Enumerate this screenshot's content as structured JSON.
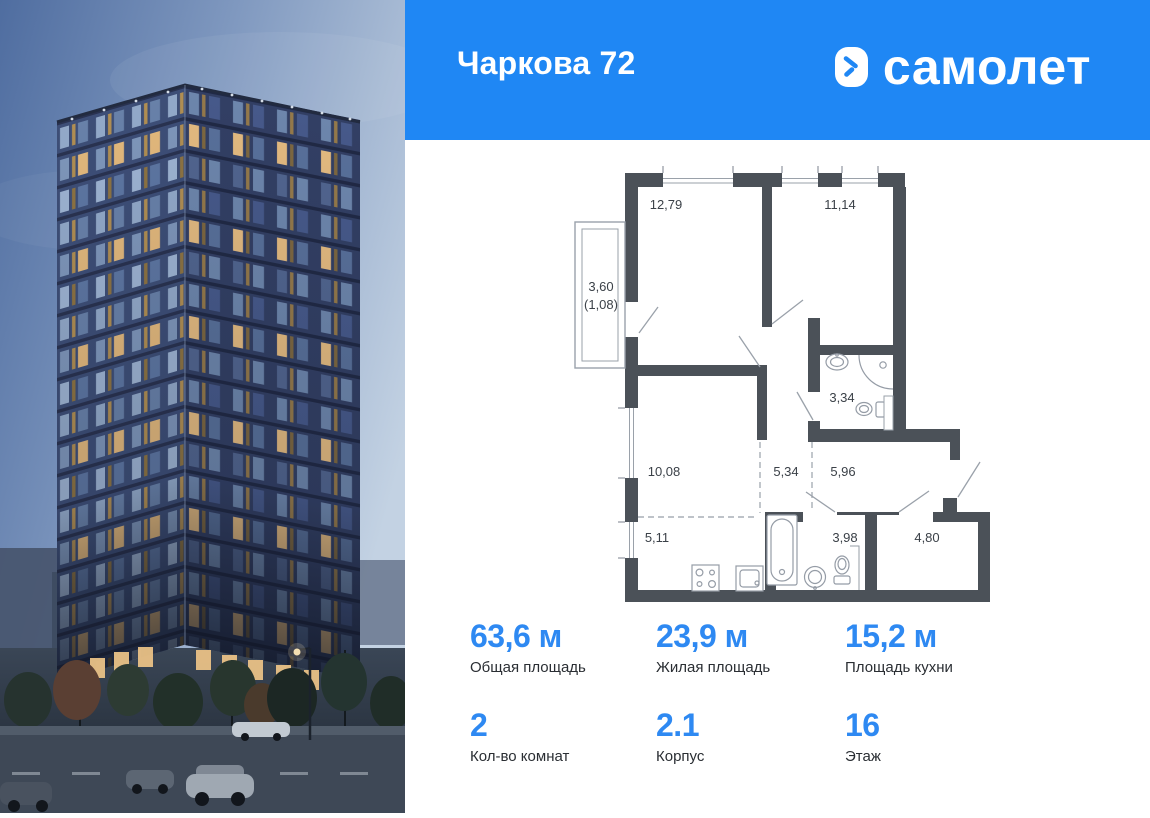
{
  "header": {
    "title": "Чаркова 72",
    "brand": "самолет",
    "bg_color": "#1f87f4"
  },
  "floor_plan": {
    "wall_color": "#4b5158",
    "rooms": [
      {
        "name": "room-12-79",
        "area": "12,79"
      },
      {
        "name": "room-11-14",
        "area": "11,14"
      },
      {
        "name": "bathroom-3-34",
        "area": "3,34"
      },
      {
        "name": "room-10-08",
        "area": "10,08"
      },
      {
        "name": "hall-5-34",
        "area": "5,34"
      },
      {
        "name": "corridor-5-96",
        "area": "5,96"
      },
      {
        "name": "kitchen-5-11",
        "area": "5,11"
      },
      {
        "name": "bathroom-3-98",
        "area": "3,98"
      },
      {
        "name": "entry-4-80",
        "area": "4,80"
      }
    ],
    "balcony": {
      "area": "3,60",
      "reduced_area": "(1,08)"
    }
  },
  "stats": {
    "accent_color": "#2e89f2",
    "items": [
      {
        "value": "63,6 м",
        "label": "Общая площадь"
      },
      {
        "value": "23,9 м",
        "label": "Жилая площадь"
      },
      {
        "value": "15,2 м",
        "label": "Площадь кухни"
      },
      {
        "value": "2",
        "label": "Кол-во комнат"
      },
      {
        "value": "2.1",
        "label": "Корпус"
      },
      {
        "value": "16",
        "label": "Этаж"
      }
    ]
  }
}
